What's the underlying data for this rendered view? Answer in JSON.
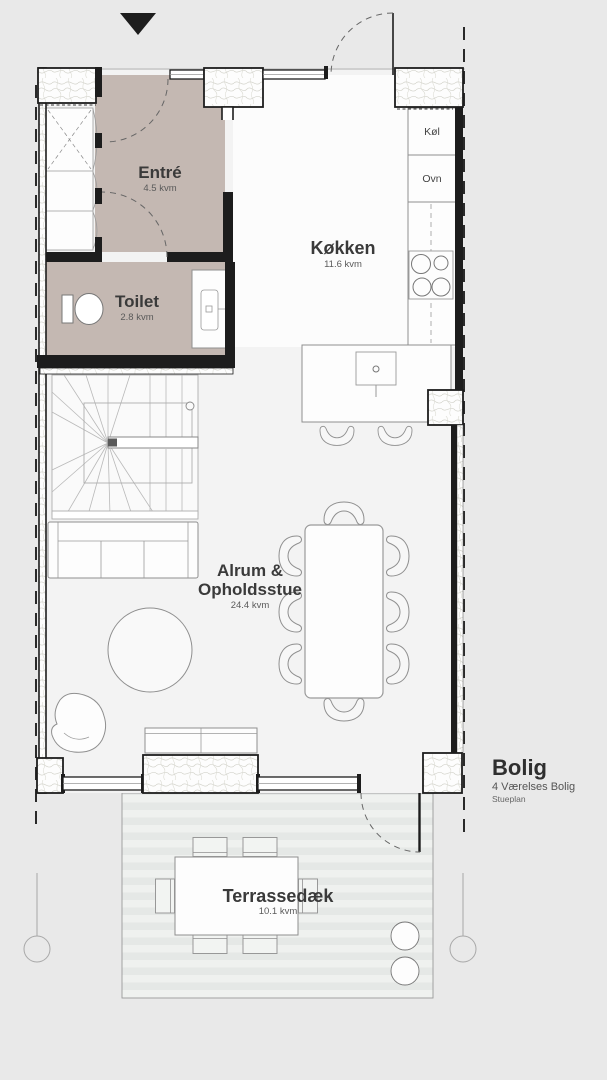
{
  "title_block": {
    "title": "Bolig",
    "subtitle": "4 Værelses Bolig",
    "level": "Stueplan"
  },
  "rooms": {
    "entre": {
      "label": "Entré",
      "area": "4.5 kvm"
    },
    "toilet": {
      "label": "Toilet",
      "area": "2.8 kvm"
    },
    "kitchen": {
      "label": "Køkken",
      "area": "11.6 kvm"
    },
    "living": {
      "label_line1": "Alrum &",
      "label_line2": "Opholdsstue",
      "area": "24.4 kvm"
    },
    "terrace": {
      "label": "Terrassedæk",
      "area": "10.1 kvm"
    }
  },
  "appliances": {
    "fridge": "Køl",
    "oven": "Ovn"
  },
  "icons": {
    "entrance_marker": "triangle-down-arrow"
  },
  "colors": {
    "background": "#e9e9e9",
    "floor": "#f3f3f3",
    "kitchen_floor": "#fcfcfc",
    "wet_room_fill": "#c4b8b2",
    "wall": "#1d1d1d",
    "furniture_line": "#8f8f8f",
    "deck_stripe_light": "#eff1ef",
    "deck_stripe_dark": "#e5e8e6",
    "label_text": "#3a3a3a",
    "area_text": "#5a5a5a"
  }
}
